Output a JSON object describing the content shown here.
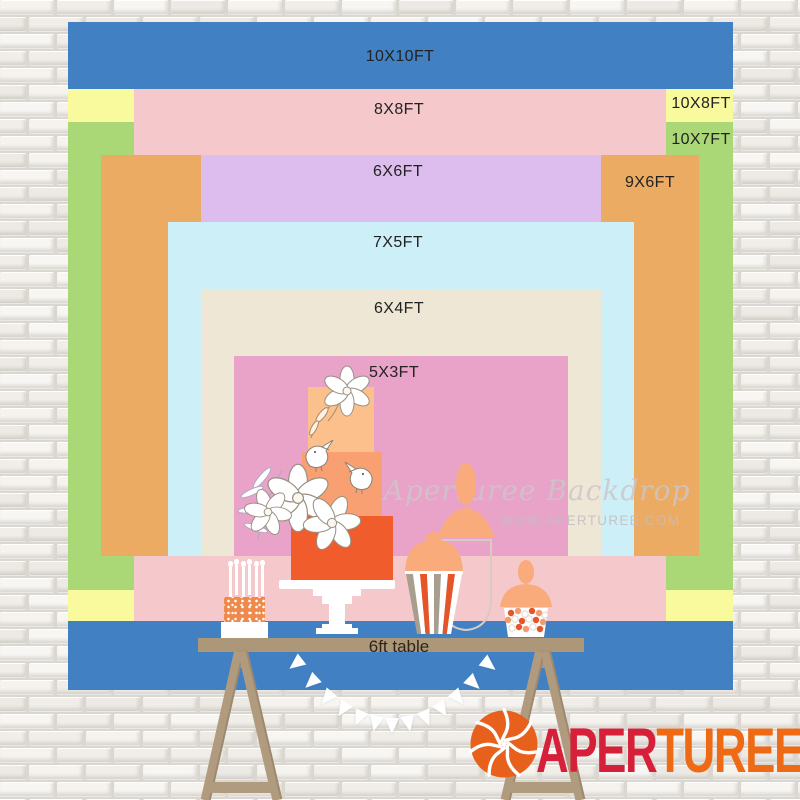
{
  "brand": "APERTUREE",
  "sizes": [
    {
      "label": "10X10FT",
      "width_ft": 10,
      "height_ft": 10,
      "color": "#4180c3"
    },
    {
      "label": "8X8FT",
      "width_ft": 8,
      "height_ft": 8,
      "color": "#f5c9cb"
    },
    {
      "label": "10X8FT",
      "width_ft": 10,
      "height_ft": 8,
      "color": "#f9f99e"
    },
    {
      "label": "10X7FT",
      "width_ft": 10,
      "height_ft": 7,
      "color": "#abd877"
    },
    {
      "label": "6X6FT",
      "width_ft": 6,
      "height_ft": 6,
      "color": "#dcbded"
    },
    {
      "label": "9X6FT",
      "width_ft": 9,
      "height_ft": 6,
      "color": "#ecab62"
    },
    {
      "label": "7X5FT",
      "width_ft": 7,
      "height_ft": 5,
      "color": "#cdeff8"
    },
    {
      "label": "6X4FT",
      "width_ft": 6,
      "height_ft": 4,
      "color": "#eee7d6"
    },
    {
      "label": "5X3FT",
      "width_ft": 5,
      "height_ft": 3,
      "color": "#e9a3c8"
    }
  ],
  "table": {
    "label": "6ft table"
  },
  "watermark": {
    "script": "Aperturee Backdrop",
    "url": "WWW.APERTUREE.COM"
  },
  "logo": {
    "red_text": "APER",
    "orange_text": "TUREE",
    "red": "#d6203a",
    "orange": "#ee6a15",
    "icon": "aperture-shutter"
  }
}
